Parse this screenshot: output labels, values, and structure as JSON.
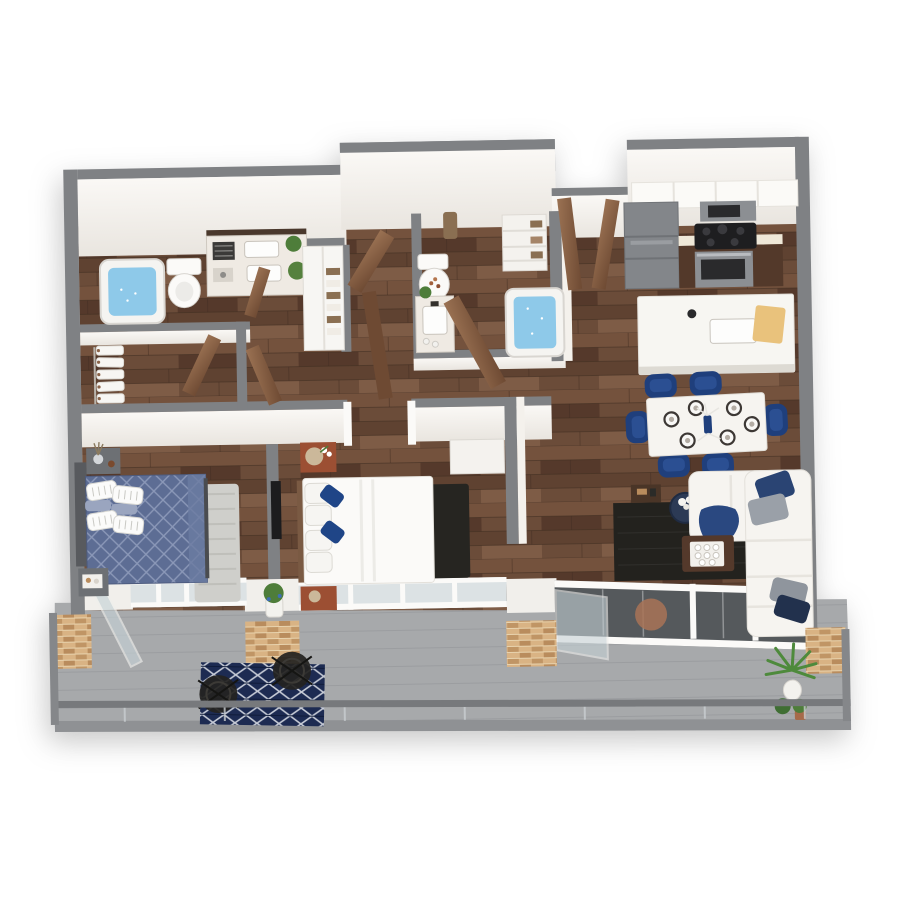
{
  "title": "3D rendered two-bedroom apartment floor plan with balcony",
  "palette": {
    "wall_cap": "#7f8184",
    "wall_face": "#f4f1ec",
    "wall_face_shade": "#e9e5df",
    "wood": "#6b4c39",
    "wood_dark": "#583e2e",
    "balcony_floor": "#a7a9ab",
    "balcony_edge": "#8f9194",
    "rail_gray": "#77797c",
    "water_blue": "#8ec9e9",
    "fixture_white": "#f5f4f1",
    "marble": "#efeae3",
    "navy": "#1f3f7c",
    "navy_deep": "#22314d",
    "duvet_blue": "#5d6d94",
    "cherry": "#9c4f33",
    "door_brown": "#8a6348",
    "cabinet_dark": "#53392a",
    "counter_cream": "#efe8d8",
    "appliance_gray": "#8c8f93",
    "fridge_gray": "#83868a",
    "sofa_white": "#f6f4f0",
    "rug_dark": "#23221e",
    "rug_navy": "#1d2b52",
    "rug_gray": "#cfcfcb",
    "brick_tan": "#d9b384",
    "glass_dark": "#55595c",
    "glass_light": "#dce2e4",
    "plant_green": "#4e7d3a",
    "towel_brown": "#8a6f52",
    "headboard_gray": "#585a5e",
    "nightstand_gray": "#6d7074",
    "tv_black": "#1c1c1e",
    "ottoman_leather": "#a97356"
  },
  "scene": {
    "view": "isometric 3D dollhouse render, white background",
    "rooms": [
      {
        "name": "primary-bathroom",
        "furniture": [
          "bathtub-with-water",
          "toilet",
          "double-sink-vanity",
          "folded-towels",
          "potted-plants"
        ]
      },
      {
        "name": "walk-in-closet",
        "furniture": [
          "hanging-clothes-rod",
          "white-garments"
        ]
      },
      {
        "name": "primary-bedroom",
        "furniture": [
          "blue-diamond-quilt-bed",
          "slat-headboard",
          "gray-nightstand-with-vase",
          "gray-bench-with-tray",
          "light-gray-rug"
        ]
      },
      {
        "name": "hall-closet",
        "furniture": [
          "white-utility-unit",
          "towel-shelves"
        ]
      },
      {
        "name": "second-bathroom",
        "furniture": [
          "toilet",
          "marble-vanity-sink",
          "bathtub-with-water",
          "wall-towel",
          "linen-shelf"
        ]
      },
      {
        "name": "second-bedroom",
        "furniture": [
          "white-bed",
          "navy-accent-pillows",
          "cherry-nightstands",
          "rattan-lamp",
          "tv-panel",
          "dark-runner-rug",
          "white-dresser"
        ]
      },
      {
        "name": "entry",
        "furniture": [
          "entry-door",
          "closet-door"
        ]
      },
      {
        "name": "kitchen",
        "furniture": [
          "refrigerator",
          "microwave",
          "cooktop-range-oven",
          "upper-cabinets",
          "dark-lower-cabinets",
          "island-with-sink",
          "cutting-board"
        ]
      },
      {
        "name": "dining-area",
        "furniture": [
          "white-dining-table",
          "navy-dining-chairs",
          "place-settings",
          "blue-vase-centerpiece"
        ]
      },
      {
        "name": "living-room",
        "furniture": [
          "white-sectional-sofa",
          "navy-and-gray-pillows",
          "navy-throw",
          "dark-area-rug",
          "wood-coffee-table",
          "tray-with-cups",
          "round-side-table",
          "console-table",
          "leather-ottoman"
        ]
      },
      {
        "name": "balcony",
        "furniture": [
          "glass-railing",
          "brick-piers",
          "navy-outdoor-rug",
          "wire-chairs",
          "potted-palm",
          "small-plants",
          "flower-pot",
          "open-glass-door"
        ]
      }
    ],
    "counts": {
      "dining_chairs": 6,
      "place_settings": 6,
      "balcony_chairs": 2,
      "bed_pillow_pairs": 2,
      "brick_piers": 4
    }
  }
}
